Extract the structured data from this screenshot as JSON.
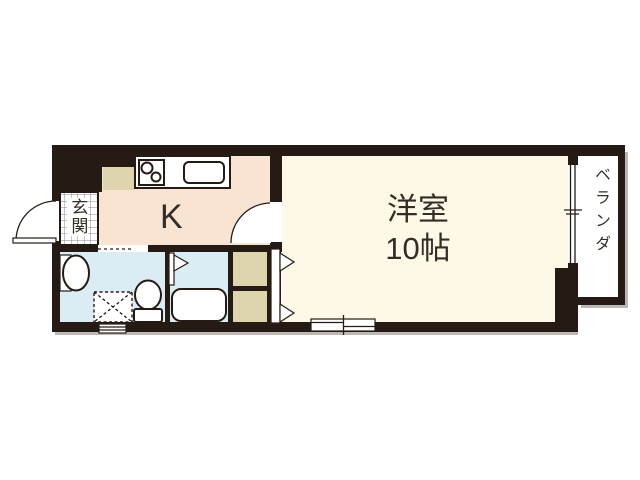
{
  "floorplan": {
    "rooms": {
      "entrance": {
        "label": "玄関"
      },
      "kitchen": {
        "label": "K"
      },
      "main_room": {
        "label": "洋室",
        "size": "10帖"
      },
      "veranda": {
        "label": "ベランダ"
      }
    },
    "colors": {
      "wall": "#261b14",
      "kitchen_floor": "#f9e3d3",
      "main_room_floor": "#fdf9e6",
      "wet_area_floor": "#dcecf5",
      "closet": "#ded5ae",
      "veranda_floor": "#ffffff",
      "tile_line": "#8a8a8a",
      "shadow": "#bdb8b4",
      "text": "#332d28"
    }
  }
}
